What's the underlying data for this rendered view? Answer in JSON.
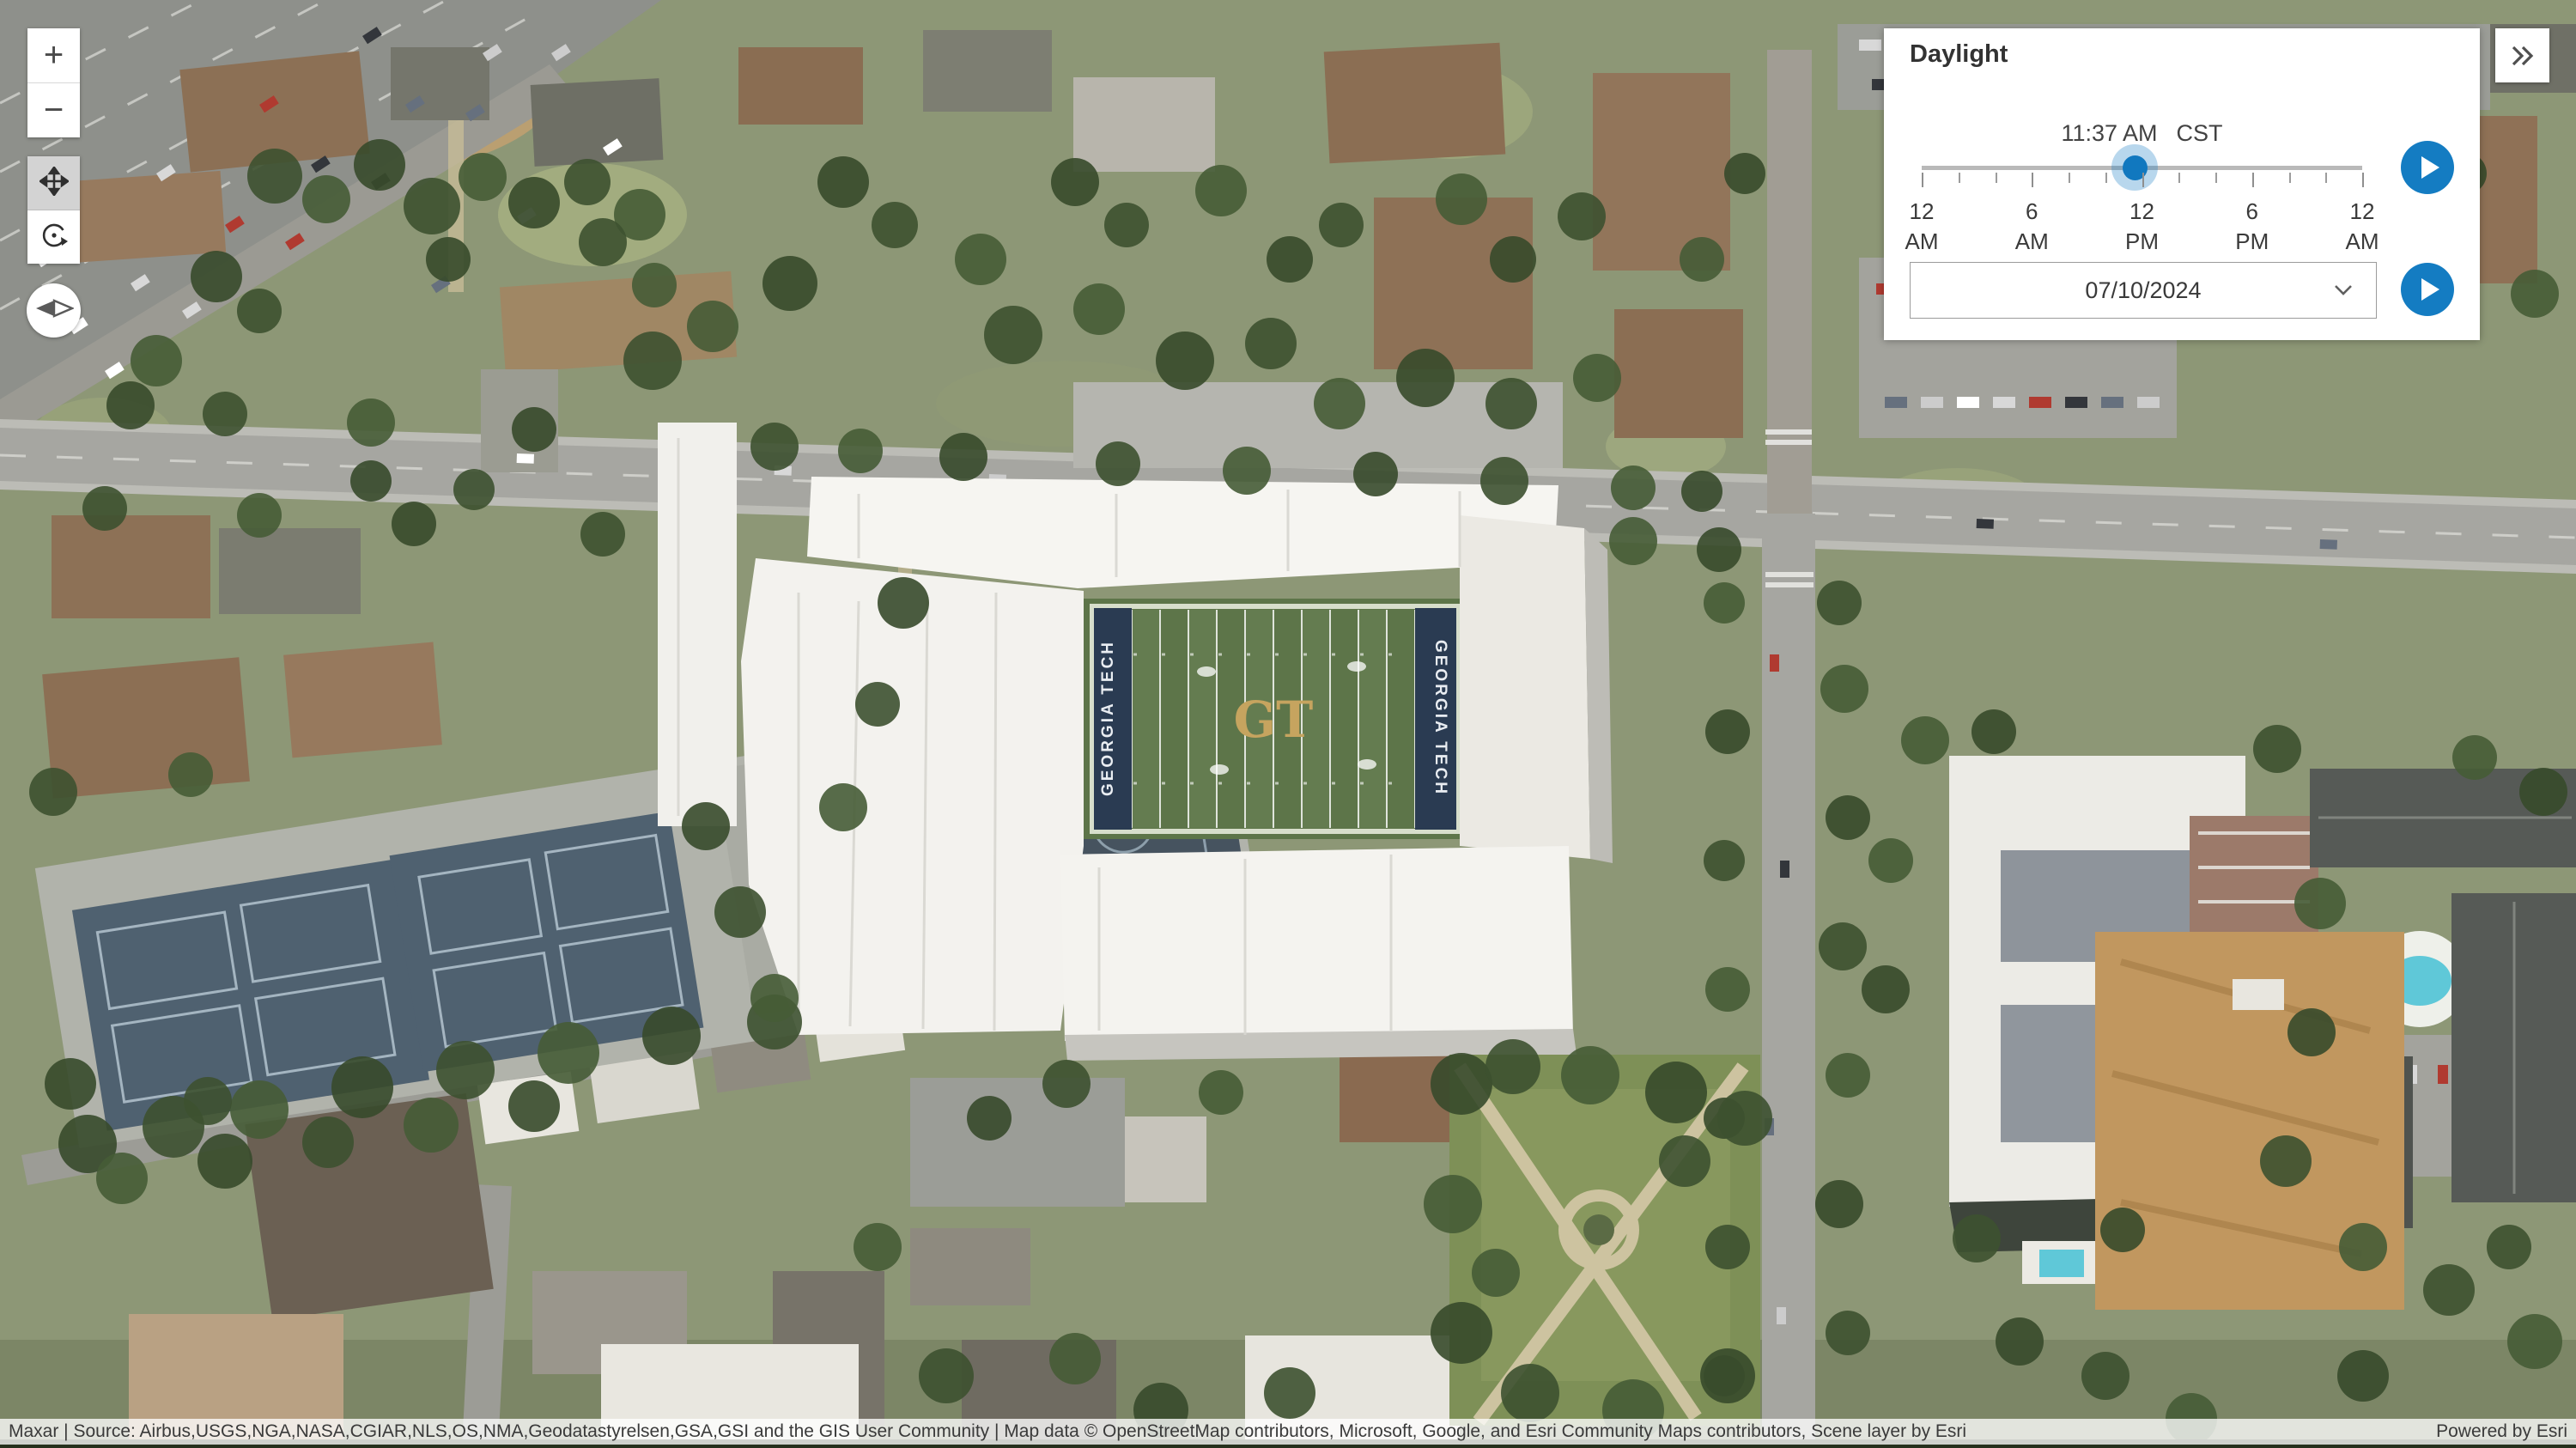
{
  "colors": {
    "accent_blue": "#147CC2",
    "handle_halo": "rgba(20,124,194,0.30)",
    "active_tool_bg": "#D3D3D3"
  },
  "controls": {
    "zoom_in_label": "+",
    "zoom_out_label": "−"
  },
  "panel": {
    "title": "Daylight",
    "time": "11:37 AM",
    "timezone": "CST",
    "slider": {
      "tick_count": 13,
      "handle_fraction": 0.4835,
      "labels": [
        {
          "hour": "12",
          "period": "AM"
        },
        {
          "hour": "6",
          "period": "AM"
        },
        {
          "hour": "12",
          "period": "PM"
        },
        {
          "hour": "6",
          "period": "PM"
        },
        {
          "hour": "12",
          "period": "AM"
        }
      ]
    },
    "date": "07/10/2024"
  },
  "map": {
    "field_center_logo": "GT",
    "endzone_left_text": "GEORGIA TECH",
    "endzone_right_text": "GEORGIA TECH"
  },
  "attribution": {
    "sources": "Maxar | Source: Airbus,USGS,NGA,NASA,CGIAR,NLS,OS,NMA,Geodatastyrelsen,GSA,GSI and the GIS User Community | Map data © OpenStreetMap contributors, Microsoft, Google, and Esri Community Maps contributors, Scene layer by Esri",
    "powered_by": "Powered by Esri"
  }
}
